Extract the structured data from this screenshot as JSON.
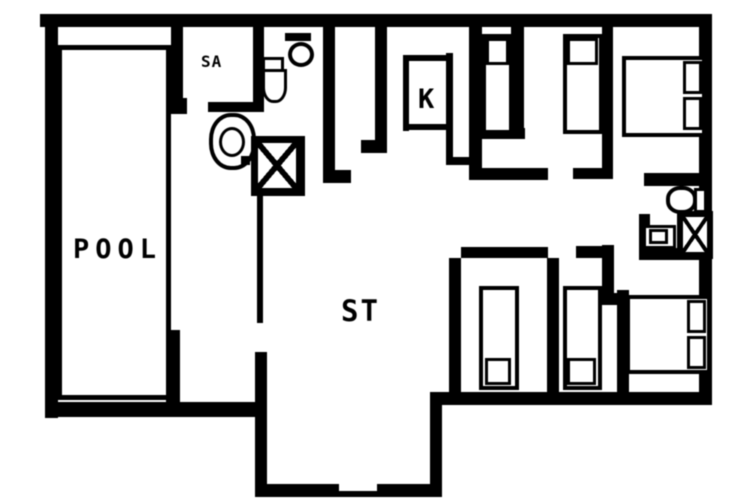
{
  "diagram": {
    "type": "floor-plan",
    "colors": {
      "wall": "#000000",
      "background": "#ffffff"
    },
    "rooms": {
      "pool": {
        "label": "POOL"
      },
      "sauna": {
        "label": "SA"
      },
      "kitchen": {
        "label": "K"
      },
      "living": {
        "label": "ST"
      }
    },
    "fixtures": {
      "icon_names": [
        "toilet-icon",
        "sink-icon",
        "shower-icon",
        "single-bed",
        "double-bed",
        "pillow",
        "door-opening"
      ],
      "toilets": 3,
      "showers": 2,
      "sinks": 2,
      "single_beds": 4,
      "double_beds": 2
    }
  }
}
